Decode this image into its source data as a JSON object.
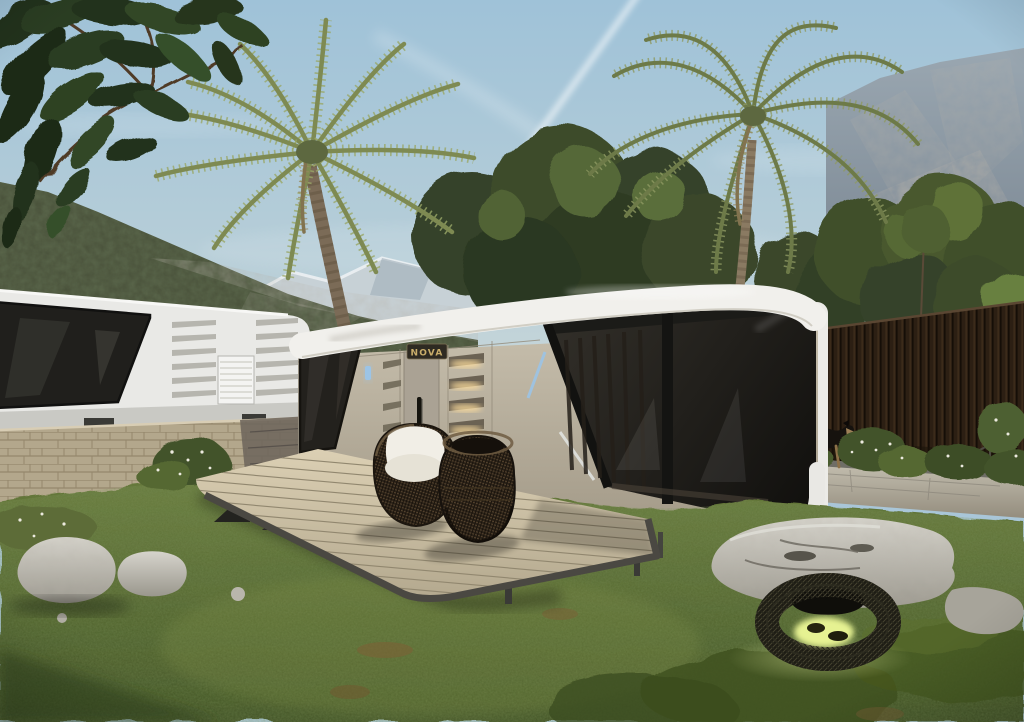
{
  "scene": {
    "title": "Futuristic capsule tiny house in an alpine garden",
    "type": "photorealistic 3D exterior render",
    "time_of_day": "sunny daytime, clear sky",
    "brand_plaque": "NOVA",
    "description": "Two futuristic prefab capsule homes set in a grassy mountain garden with palm trees, a wooden terrace deck with rattan chairs, a dark timber fence with a walking dog, boulders and a glowing wire garden lantern."
  },
  "environment": {
    "sky": {
      "label": "clear blue sky with two crossing jet contrails",
      "color_top": "#9fc2d8",
      "color_horizon": "#ccd9da",
      "contrail_count": 2
    },
    "mountains": [
      {
        "label": "forested alpine slope with rocky scree",
        "position": "background left",
        "color": "#49513a"
      },
      {
        "label": "snow-capped distant ridge",
        "position": "background center-left",
        "color": "#ccd5da"
      },
      {
        "label": "rocky cliff face",
        "position": "background right",
        "color": "#8b98a3"
      }
    ],
    "vegetation": [
      {
        "label": "overhanging dark leafy branch",
        "position": "top-left corner"
      },
      {
        "label": "date palm",
        "position": "center-left"
      },
      {
        "label": "tall coconut palm",
        "position": "center-right"
      },
      {
        "label": "deciduous tree canopy",
        "position": "behind main capsule and right fence"
      },
      {
        "label": "flowering white shrubs",
        "position": "along fence, wall and path"
      },
      {
        "label": "lawn with moss mounds and dirt patches",
        "position": "foreground",
        "color": "#55682f"
      }
    ],
    "animals": [
      {
        "label": "black-and-tan dog walking",
        "position": "right, on stone path in front of fence"
      }
    ]
  },
  "structures": {
    "main_capsule": {
      "label": "futuristic capsule tiny house",
      "body_color": "#b5ac9b",
      "roof_color": "#f1f0ec",
      "glass_color": "#17150f",
      "features": [
        "wraparound tinted corner glazing with black frames",
        "angled louvered vents with warm interior lights",
        "entry door with brand plaque and black handle",
        "blue LED accent strips",
        "white rounded roof band and bumper trim"
      ]
    },
    "secondary_capsule": {
      "label": "white capsule unit on stone wall",
      "position": "background left",
      "body_color": "#e9e9e6",
      "window_color": "#1e1d1a"
    },
    "deck": {
      "label": "wooden terrace deck with steel fin supports and slim legs",
      "plank_color": "#ccc1a6",
      "trim_color": "#4a4842"
    },
    "stone_wall": {
      "label": "beige stone retaining wall",
      "color": "#b3a78c"
    },
    "fence": {
      "label": "dark vertical timber slat fence",
      "position": "right",
      "color": "#2c1f13"
    },
    "path": {
      "label": "stone walkway along fence",
      "color": "#b7b2a4"
    }
  },
  "furniture": [
    {
      "label": "rattan barrel chair with white cushion",
      "position": "on deck, left"
    },
    {
      "label": "woven rattan lounge chair on drum base",
      "position": "on deck, right"
    },
    {
      "label": "wire-mesh garden lantern, glowing warm green",
      "position": "foreground right, on grass"
    }
  ],
  "rocks": [
    {
      "label": "white-grey boulders",
      "position": "bottom left on grass"
    },
    {
      "label": "large flat grey boulder",
      "position": "bottom right in front of capsule"
    }
  ],
  "palette": {
    "sky": "#a9c6d8",
    "grass": "#55682f",
    "capsule_body": "#b5ac9b",
    "capsule_roof": "#f1f0ec",
    "glass": "#17150f",
    "deck": "#ccc1a6",
    "fence": "#2c1f13",
    "stone": "#b3a78c",
    "led_blue": "#9cc4e6",
    "interior_warm_light": "#ffdf9e",
    "lantern_glow": "#e6f292"
  }
}
